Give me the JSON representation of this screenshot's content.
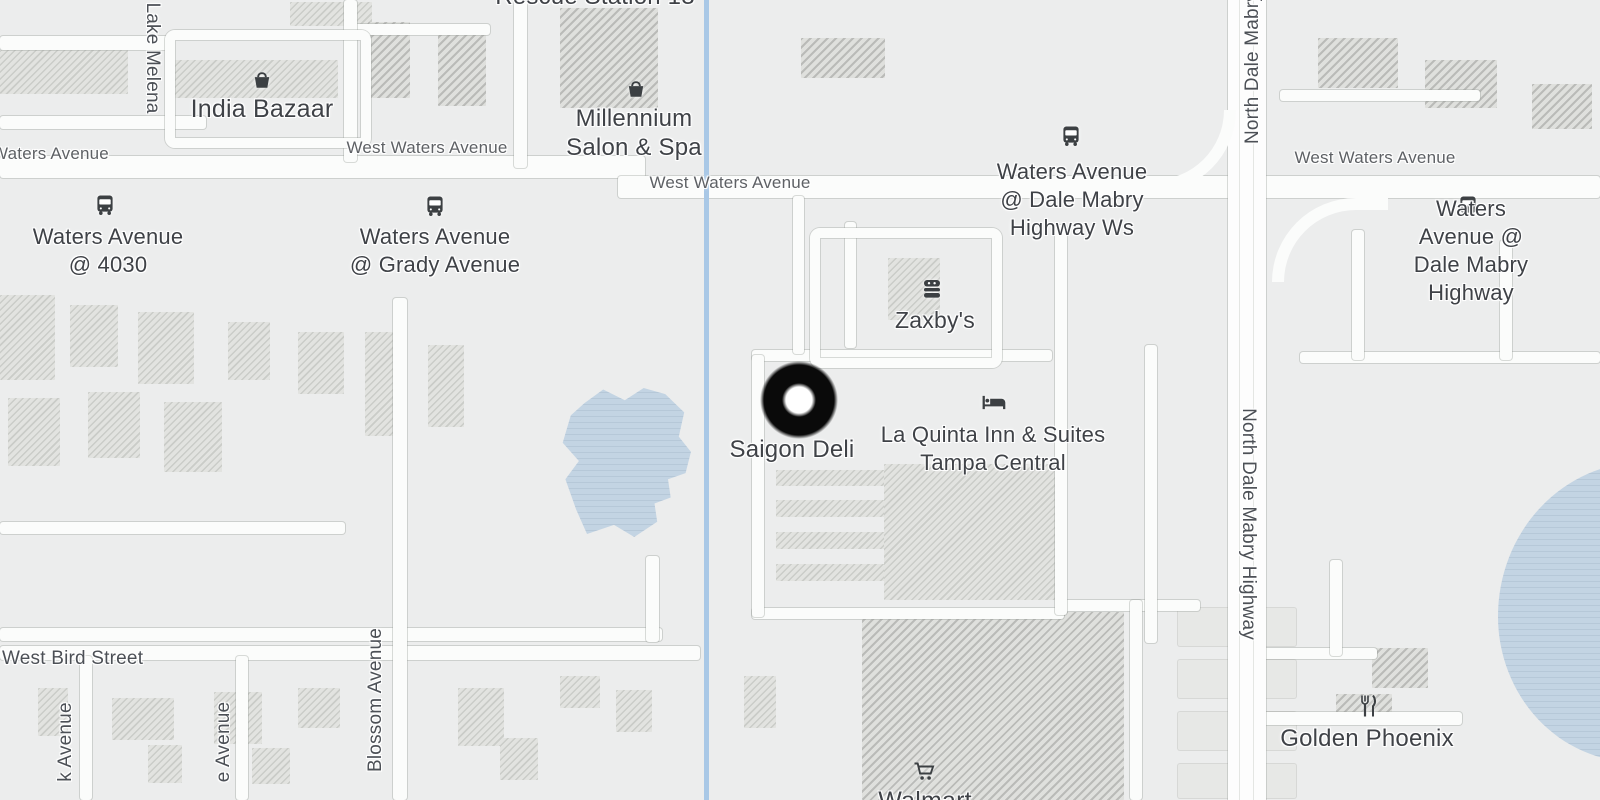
{
  "map_labels": {
    "rescue_station": "Rescue Station 13",
    "india_bazaar": "India Bazaar",
    "millennium_salon": "Millennium\nSalon & Spa",
    "lake_melena": "Lake Melena",
    "west_waters_left": "Waters Avenue",
    "west_waters_center": "West Waters Avenue",
    "west_waters_mid": "West Waters Avenue",
    "west_waters_right": "West Waters Avenue",
    "zaxbys": "Zaxby's",
    "saigon_deli": "Saigon Deli",
    "la_quinta": "La Quinta Inn & Suites\nTampa Central",
    "north_dale_mabry_top": "North Dale Mabry",
    "north_dale_mabry_mid": "North Dale Mabry Highway",
    "west_bird_street": "West Bird Street",
    "blossom_avenue": "Blossom Avenue",
    "k_avenue": "k Avenue",
    "e_avenue": "e Avenue",
    "walmart": "Walmart",
    "golden_phoenix": "Golden Phoenix"
  },
  "transit_stops": [
    {
      "label": "Waters Avenue\n@ 4030"
    },
    {
      "label": "Waters Avenue\n@ Grady Avenue"
    },
    {
      "label": "Waters Avenue\n@ Dale Mabry\nHighway Ws"
    },
    {
      "label": "Waters Avenue @\nDale Mabry Highway"
    }
  ],
  "marker": {
    "poi": "Saigon Deli"
  },
  "colors": {
    "land": "#eceded",
    "road": "#fbfcfb",
    "water": "#c3d4e3",
    "creek": "#a9c8e6",
    "bld": "#e2e3e0",
    "bld_dark": "#dfe0dd",
    "label": "#3f4247",
    "road_label": "#5e6165",
    "street_label": "#4c5056",
    "icon": "#3c4043",
    "marker": "#0a0a0a"
  }
}
